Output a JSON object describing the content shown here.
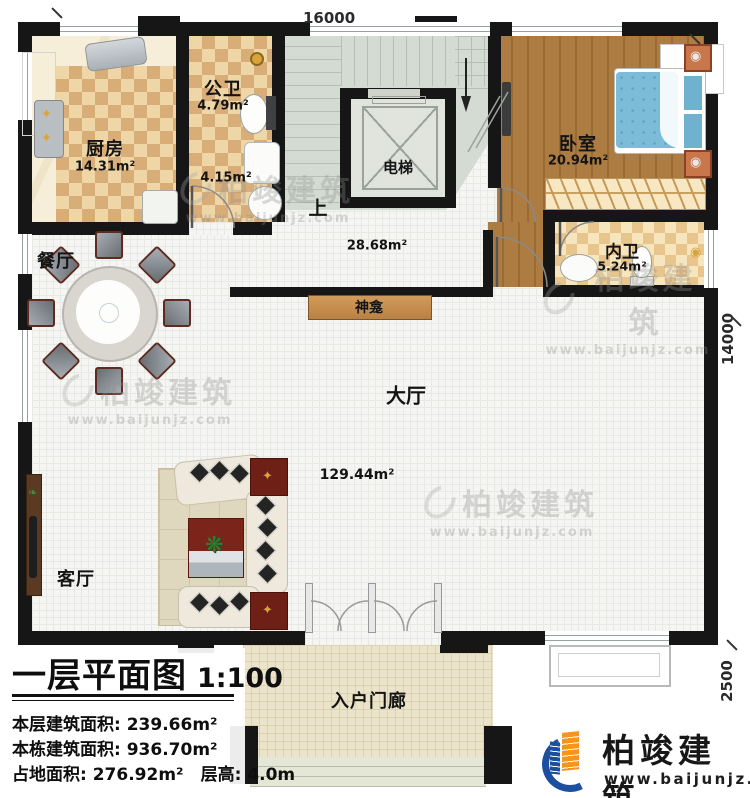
{
  "plan": {
    "drawing_title": "一层平面图",
    "scale": "1:100"
  },
  "rooms": {
    "kitchen": {
      "name": "厨房",
      "area": "14.31m²"
    },
    "public_bath": {
      "name": "公卫",
      "area": "4.79m²"
    },
    "small_bath": {
      "area": "4.15m²"
    },
    "elevator": {
      "name": "电梯"
    },
    "stair_hall": {
      "up": "上",
      "area": "28.68m²"
    },
    "bedroom": {
      "name": "卧室",
      "area": "20.94m²"
    },
    "ensuite": {
      "name": "内卫",
      "area": "5.24m²"
    },
    "dining": {
      "name": "餐厅"
    },
    "shrine": {
      "name": "神龛"
    },
    "hall": {
      "name": "大厅",
      "area": "129.44m²"
    },
    "living": {
      "name": "客厅"
    },
    "porch": {
      "name": "入户门廊"
    }
  },
  "dimensions": {
    "top": "16000",
    "right": "14000",
    "right_lower": "2500"
  },
  "title_block": {
    "title": "一层平面图",
    "scale": "1:100",
    "line1": "本层建筑面积: 239.66m²",
    "line2": "本栋建筑面积: 936.70m²",
    "line3": "占地面积: 276.92m²",
    "line4": "层高: 4.0m"
  },
  "brand": {
    "name": "柏竣建筑",
    "url": "www.baijunjz.com"
  },
  "watermark": {
    "name": "柏竣建筑",
    "url": "www.baijunjz.com"
  },
  "colors": {
    "wall": "#161616",
    "wood_floor": "#ad7c42",
    "tile": "#d9ad78",
    "stair": "#d4dbd2",
    "bed": "#7cbcd8",
    "brand_blue": "#1d4fa0",
    "brand_orange": "#f7941d"
  }
}
